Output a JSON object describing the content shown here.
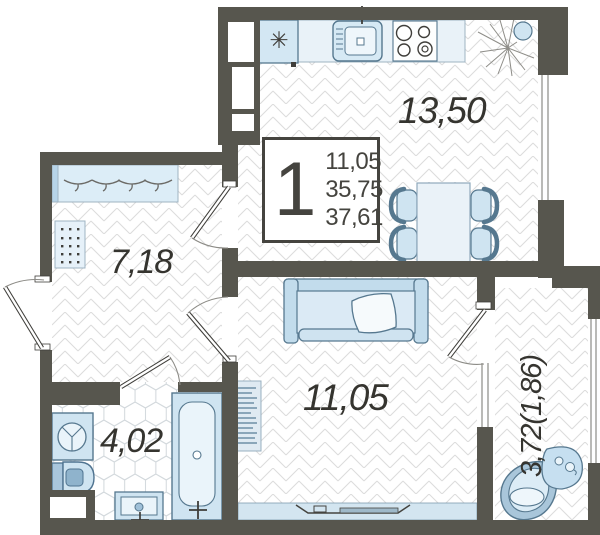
{
  "unit_card": {
    "rooms_count": "1",
    "living_area": "11,05",
    "area_no_balcony": "35,75",
    "total_area": "37,61"
  },
  "rooms": {
    "kitchen_dining": {
      "label": "13,50"
    },
    "hallway": {
      "label": "7,18"
    },
    "living_room": {
      "label": "11,05"
    },
    "bathroom": {
      "label": "4,02"
    },
    "balcony": {
      "label": "3,72(1,86)"
    }
  },
  "icons": {
    "fridge_snowflake": "✳"
  },
  "colors": {
    "wall": "#57564e",
    "furniture_stroke": "#56788f",
    "furniture_fill": "#cfe4f1",
    "furniture_light": "#e7f1f8",
    "glass": "#d3e5f0",
    "floor_line": "#dcdcdc",
    "text": "#35342f"
  }
}
